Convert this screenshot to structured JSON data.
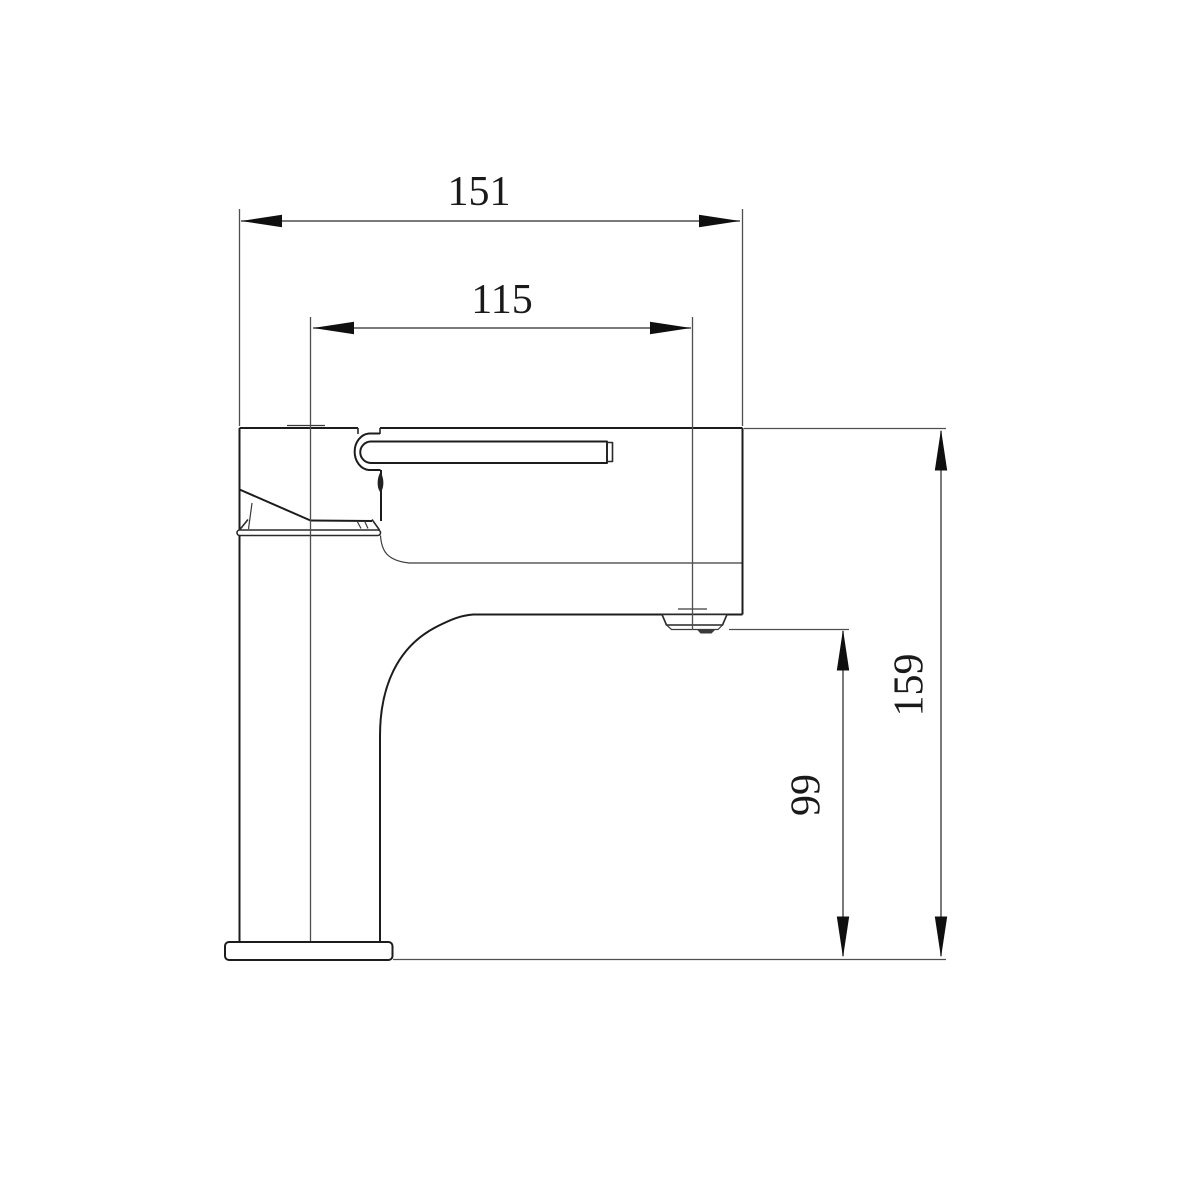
{
  "canvas": {
    "background": "#ffffff"
  },
  "colors": {
    "outline": "#1c1c1c",
    "dimension_line": "#4f4f4f",
    "arrow": "#0f0f0f",
    "text": "#1a1a1a"
  },
  "dimensions": {
    "width_overall": {
      "value": "151"
    },
    "width_to_spout_outlet": {
      "value": "115"
    },
    "height_overall": {
      "value": "159"
    },
    "spout_outlet_height": {
      "value": "99"
    }
  }
}
